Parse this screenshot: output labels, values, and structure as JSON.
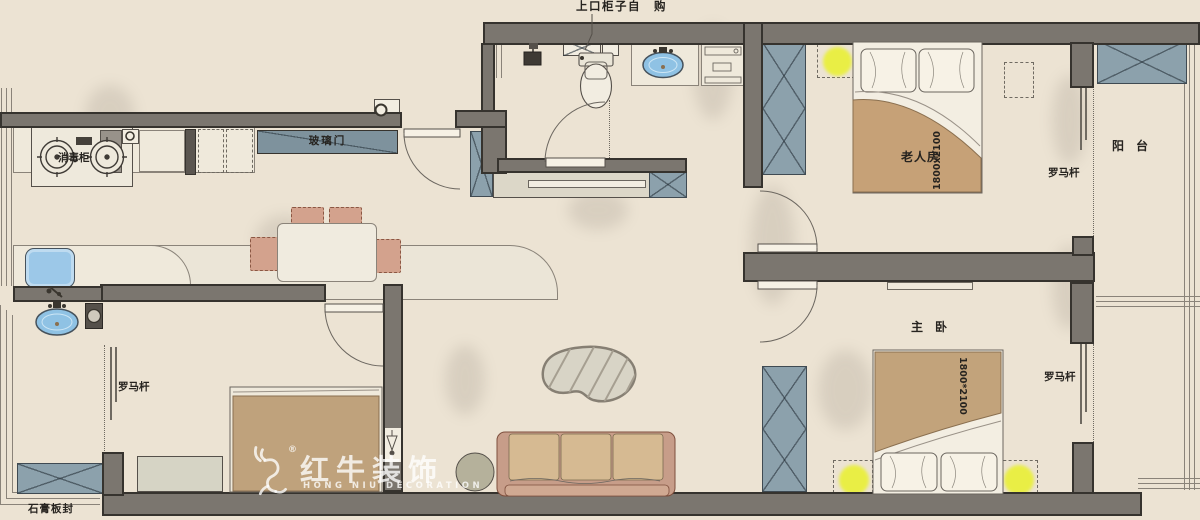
{
  "plan": {
    "annotations": {
      "top_cabinet_note": "上口柜子自　购",
      "glass_door": "玻璃门",
      "sterilizer_cabinet": "消毒柜",
      "curtain_rod": "罗马杆",
      "gypsum_board_seal": "石膏板封"
    },
    "rooms": {
      "elder_bedroom": {
        "name": "老人房",
        "bed_size": "1800x2100"
      },
      "master_bedroom": {
        "name": "主　卧",
        "bed_size": "1800*2100"
      },
      "balcony": {
        "name": "阳　台"
      }
    }
  },
  "watermark": {
    "brand_cn": "红牛装饰",
    "brand_en": "HONG NIU DECORATION",
    "registered_mark": "®",
    "logo": "bull-icon"
  },
  "colors": {
    "floor_beige": "#ece3d3",
    "wall_gray": "#7b766f",
    "cabinet_blue_gray": "#8ca1ac",
    "glass_door_blue": "#7e929d",
    "bed_tan": "#c4a47c",
    "lamp_yellow": "#e9ee45",
    "sink_blue": "#93c3e6",
    "chair_clay": "#d3a28d",
    "watermark_white": "#ffffff"
  }
}
